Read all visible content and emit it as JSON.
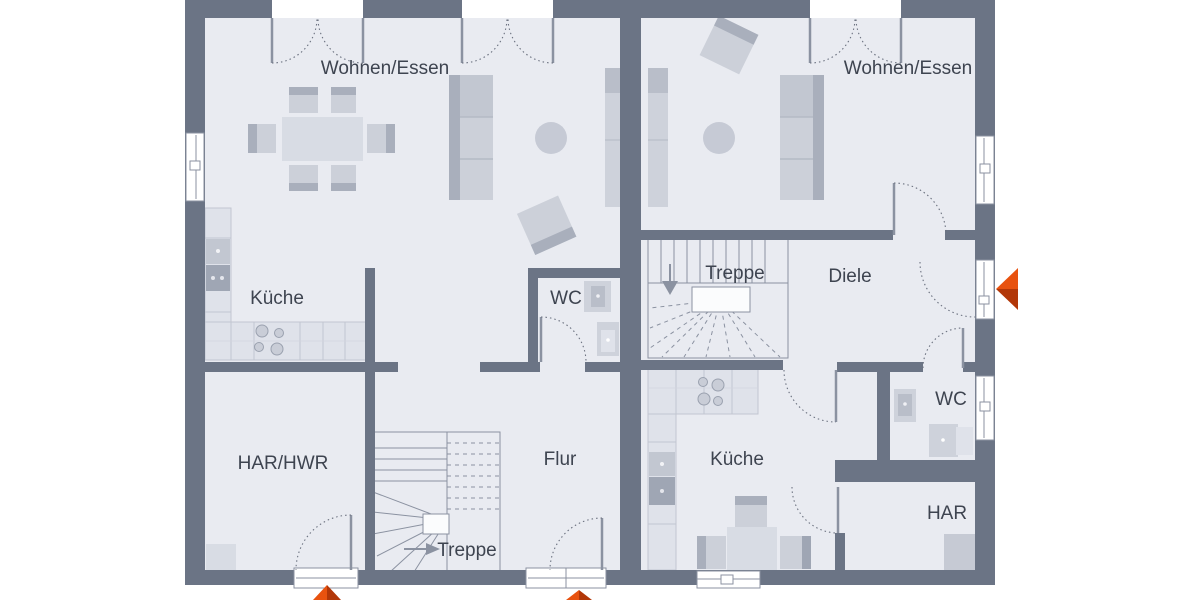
{
  "plan": {
    "kind": "floor-plan",
    "units": {
      "left": {
        "rooms": {
          "wohnen_essen": "Wohnen/Essen",
          "kueche": "Küche",
          "wc": "WC",
          "har_hwr": "HAR/HWR",
          "flur": "Flur",
          "treppe": "Treppe"
        }
      },
      "right": {
        "rooms": {
          "wohnen_essen": "Wohnen/Essen",
          "treppe": "Treppe",
          "diele": "Diele",
          "kueche": "Küche",
          "wc": "WC",
          "har": "HAR"
        }
      }
    },
    "colors": {
      "wall": "#6b7485",
      "floor": "#e9ebf1",
      "furniture_light": "#ccd0d9",
      "furniture_medium": "#b0b6c2",
      "counter": "#dfe2ea",
      "entrance_accent": "#d9440e",
      "entrance_accent_dark": "#b23708",
      "label_text": "#3e4450",
      "stair_line": "#8b92a1"
    },
    "icons": {
      "entrance_arrow_right": "entrance-arrow",
      "entrance_arrow_bottom_left": "entrance-arrow",
      "entrance_arrow_bottom_center": "entrance-arrow",
      "stair_arrow_left": "stair-direction-arrow",
      "stair_arrow_right": "stair-direction-arrow"
    }
  }
}
